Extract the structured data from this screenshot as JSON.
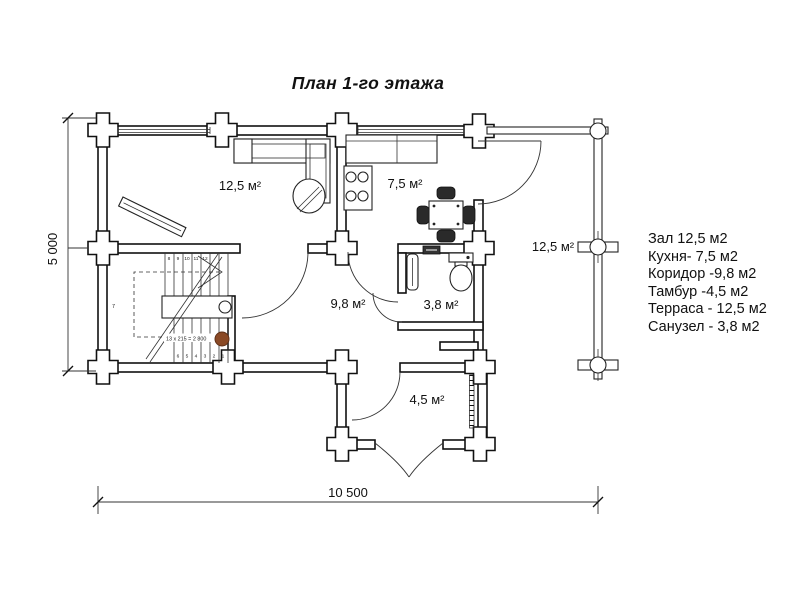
{
  "title": "План 1-го этажа",
  "legend": {
    "items": [
      "Зал 12,5 м2",
      "Кухня- 7,5 м2",
      "Коридор -9,8 м2",
      "Тамбур -4,5 м2",
      "Терраса - 12,5 м2",
      "Санузел - 3,8 м2"
    ]
  },
  "rooms": {
    "hall": "12,5 м²",
    "kitchen": "7,5 м²",
    "corridor": "9,8 м²",
    "bathroom": "3,8 м²",
    "tambour": "4,5 м²",
    "terrace": "12,5 м²"
  },
  "dimensions": {
    "width": "10 500",
    "height": "5 000"
  },
  "stairs": {
    "formula": "13 x 215 = 2 800",
    "label7": "7",
    "top_numbers": [
      "8",
      "9",
      "10",
      "11",
      "12"
    ],
    "bottom_numbers": [
      "6",
      "5",
      "4",
      "3",
      "2",
      "1"
    ]
  },
  "colors": {
    "line": "#111111",
    "newel_dot": "#8a4a26"
  }
}
